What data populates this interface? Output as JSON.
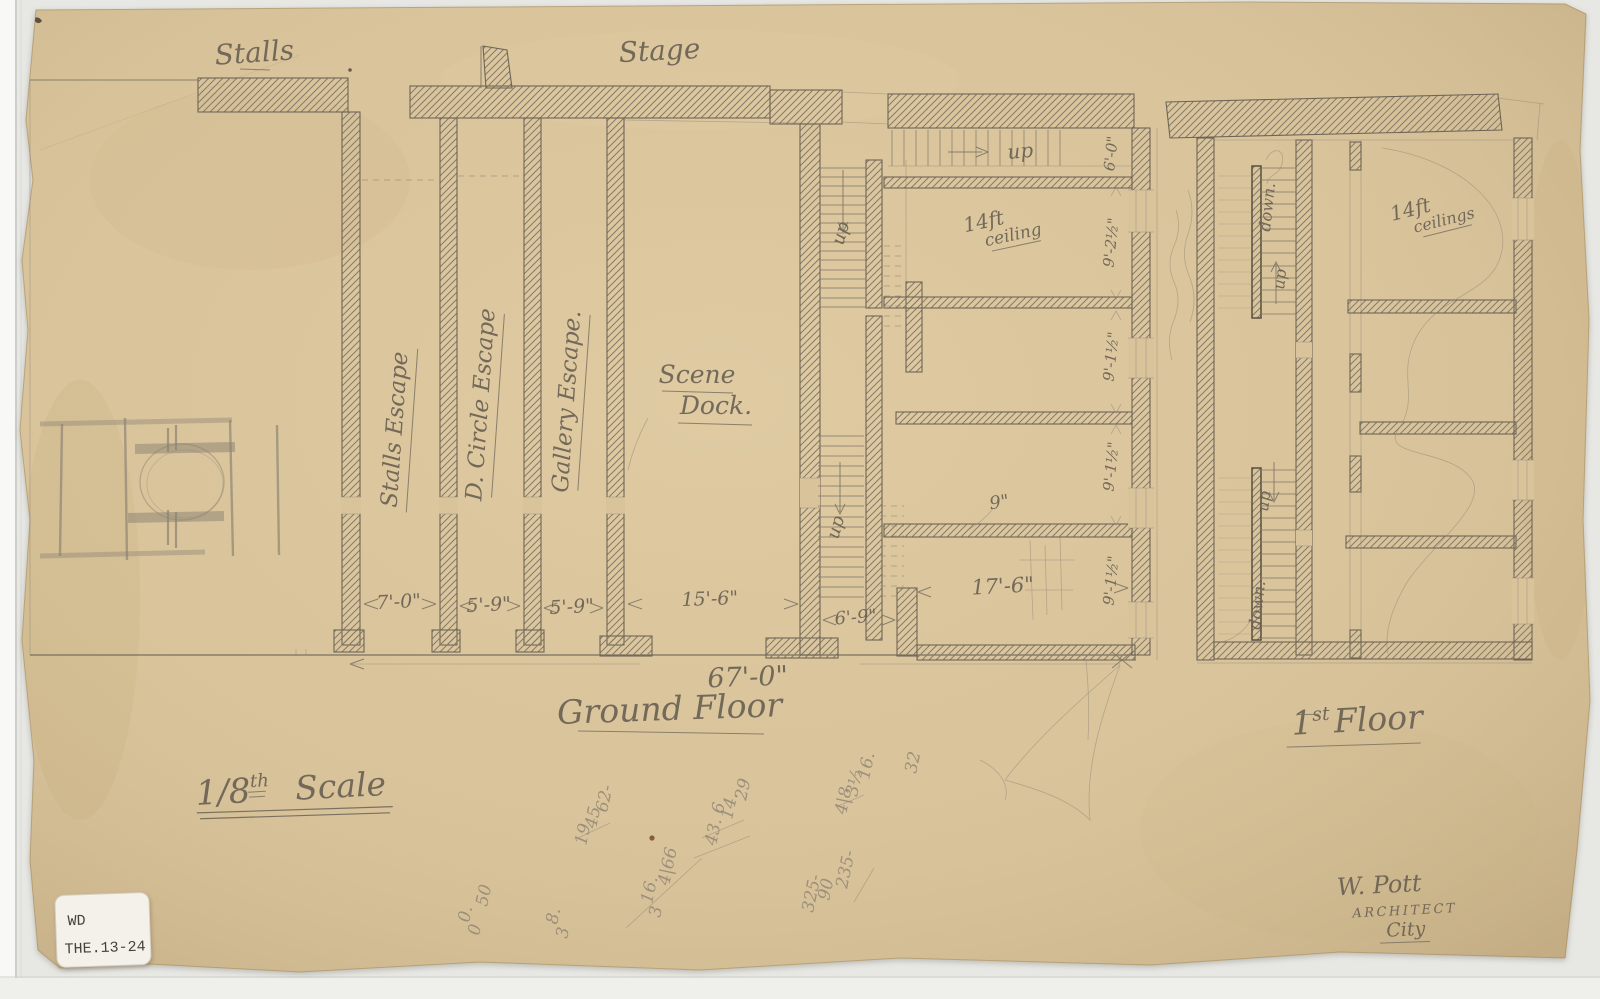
{
  "colors": {
    "paper": "#d9c39b",
    "scan_background": "#e7e7e4",
    "graphite": "#6b6254",
    "graphite_light": "#8e8474",
    "sticker": "#f3f1ea"
  },
  "titles": {
    "stalls": "Stalls",
    "stage": "Stage"
  },
  "rooms": {
    "stalls_escape": "Stalls Escape",
    "d_circle_escape": "D. Circle Escape",
    "gallery_escape": "Gallery Escape.",
    "scene": "Scene",
    "dock": "Dock.",
    "ceiling_g1": "14ft",
    "ceiling_g2": "ceiling",
    "ceiling_f1": "14ft",
    "ceiling_f2": "ceilings",
    "wall_thickness": "9\""
  },
  "stairs": {
    "up": "up",
    "down": "down."
  },
  "dims": {
    "d1": "7'-0\"",
    "d2": "5'-9\"",
    "d3": "5'-9\"",
    "d4": "15'-6\"",
    "d5": "6'-9\"",
    "d6": "17'-6\"",
    "total": "67'-0\"",
    "v1": "6'-0\"",
    "v2": "9'-2½\"",
    "v3": "9'-1½\"",
    "v4": "9'-1½\"",
    "v5": "9'-1½\""
  },
  "plan_labels": {
    "ground_floor": "Ground Floor",
    "first_floor_prefix": "1",
    "first_floor_sup": "st",
    "first_floor_word": "Floor",
    "scale_num": "1/8",
    "scale_sup": "th",
    "scale_word": "Scale"
  },
  "signature": {
    "name": "W. Pott",
    "role": "ARCHITECT",
    "city": "City"
  },
  "sticker": {
    "line1": "WD",
    "line2": "THE.13-24"
  },
  "scribbles": [
    "32",
    "16.",
    "3½",
    "4|8",
    "29",
    "14.",
    "43. 6",
    "62-",
    "45",
    "19",
    "4|66",
    "16.",
    "3",
    "325-",
    "90",
    "235-",
    "8.",
    "3",
    "50",
    "0.",
    "0"
  ]
}
